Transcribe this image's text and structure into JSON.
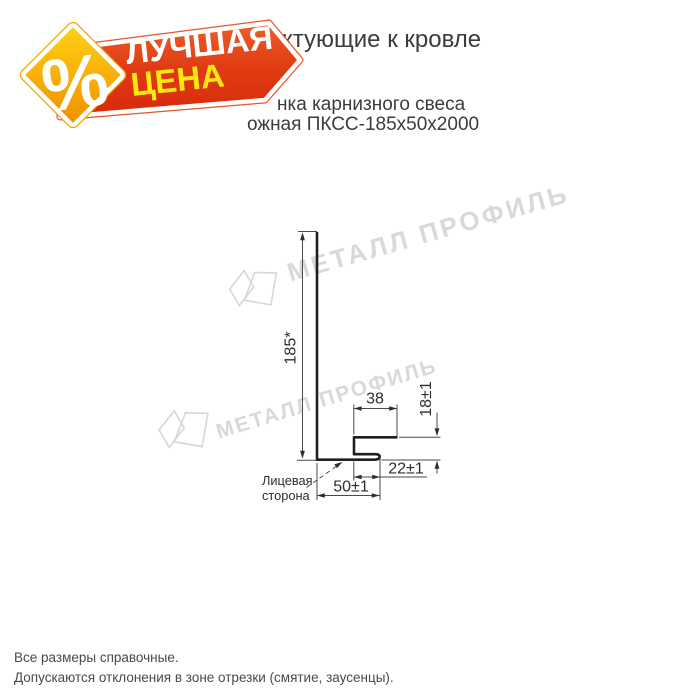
{
  "badge": {
    "percent_symbol": "%",
    "banner_line1": "ЛУЧШАЯ",
    "banner_line2": "ЦЕНА"
  },
  "header": {
    "title_visible_fragment": "ктующие к кровле",
    "subtitle_line1_visible_fragment": "нка карнизного свеса",
    "subtitle_line2_visible_fragment": "ожная ПКСС-185х50х2000"
  },
  "watermark": {
    "brand_text": "МЕТАЛЛ ПРОФИЛЬ"
  },
  "drawing": {
    "dim_height": "185*",
    "dim_top_flange": "38",
    "dim_edge_height": "18±1",
    "dim_hem_width": "22±1",
    "dim_bottom_flange": "50±1",
    "face_label_line1": "Лицевая",
    "face_label_line2": "сторона"
  },
  "footer": {
    "note1": "Все размеры справочные.",
    "note2": "Допускаются отклонения в зоне отрезки (смятие, заусенцы)."
  },
  "colors": {
    "banner_red": "#dd3110",
    "banner_red_light": "#ec5f28",
    "banner_outline": "#e8542a",
    "diamond_orange": "#ef8f00",
    "diamond_yellow": "#ffd215",
    "diamond_outline": "#f4a300",
    "price_yellow": "#ffe70f",
    "text_dark": "#3c3c3c",
    "watermark_gray": "#d9d9d9",
    "line_black": "#1f1f1f"
  }
}
